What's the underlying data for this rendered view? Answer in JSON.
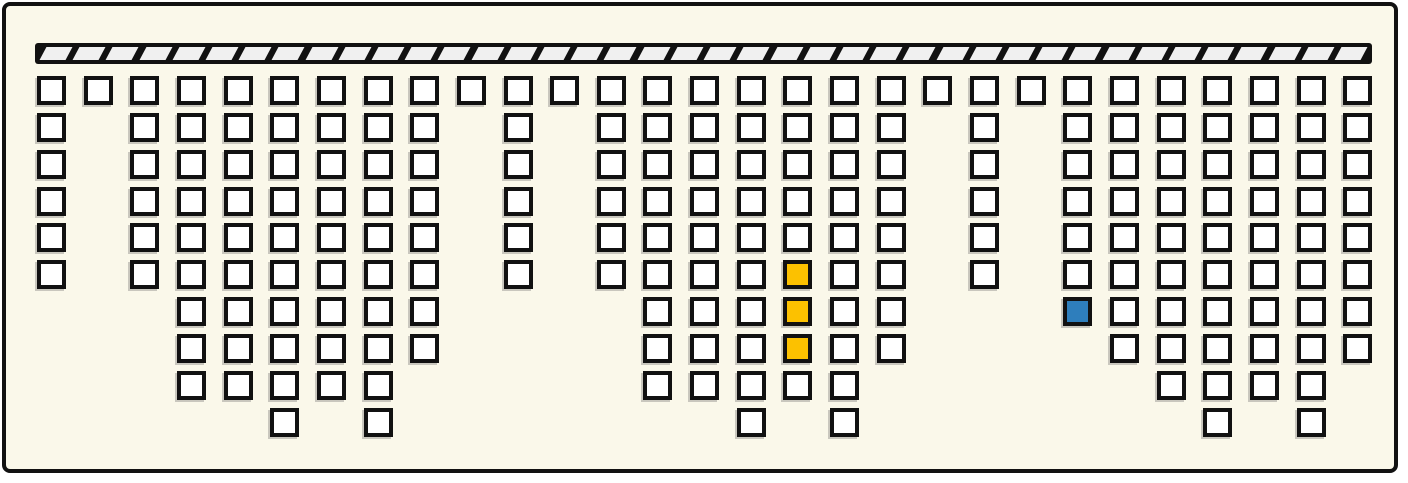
{
  "colors": {
    "background": "#faf8ea",
    "outline": "#111111",
    "cell_fill": "#ffffff",
    "highlight_yellow": "#fcc100",
    "highlight_blue": "#2e7ebc",
    "ceiling_fill": "#111111",
    "ceiling_hatch": "#f0f0f0",
    "cell_shadow": "rgba(110,110,110,0.35)"
  },
  "ceiling": {
    "x": 35,
    "y": 43,
    "width": 1337,
    "height": 21,
    "segment_count": 40,
    "segment_width": 26,
    "end_cap": 8
  },
  "grid": {
    "origin_x": 37,
    "origin_y": 76,
    "pitch_x": 46.65,
    "pitch_y": 36.85,
    "cell_size": 29,
    "max_rows": 10,
    "columns": [
      {
        "col": 1,
        "cells": 6
      },
      {
        "col": 2,
        "cells": 1
      },
      {
        "col": 3,
        "cells": 6
      },
      {
        "col": 4,
        "cells": 9
      },
      {
        "col": 5,
        "cells": 9
      },
      {
        "col": 6,
        "cells": 10
      },
      {
        "col": 7,
        "cells": 9
      },
      {
        "col": 8,
        "cells": 10
      },
      {
        "col": 9,
        "cells": 8
      },
      {
        "col": 10,
        "cells": 1
      },
      {
        "col": 11,
        "cells": 6
      },
      {
        "col": 12,
        "cells": 1
      },
      {
        "col": 13,
        "cells": 6
      },
      {
        "col": 14,
        "cells": 9
      },
      {
        "col": 15,
        "cells": 9
      },
      {
        "col": 16,
        "cells": 10
      },
      {
        "col": 17,
        "cells": 9,
        "colored": {
          "6": "yellow",
          "7": "yellow",
          "8": "yellow"
        }
      },
      {
        "col": 18,
        "cells": 10
      },
      {
        "col": 19,
        "cells": 8
      },
      {
        "col": 20,
        "cells": 1
      },
      {
        "col": 21,
        "cells": 6
      },
      {
        "col": 22,
        "cells": 1
      },
      {
        "col": 23,
        "cells": 7,
        "colored": {
          "7": "blue"
        }
      },
      {
        "col": 24,
        "cells": 8
      },
      {
        "col": 25,
        "cells": 9
      },
      {
        "col": 26,
        "cells": 10
      },
      {
        "col": 27,
        "cells": 9
      },
      {
        "col": 28,
        "cells": 10
      },
      {
        "col": 29,
        "cells": 8
      }
    ]
  }
}
